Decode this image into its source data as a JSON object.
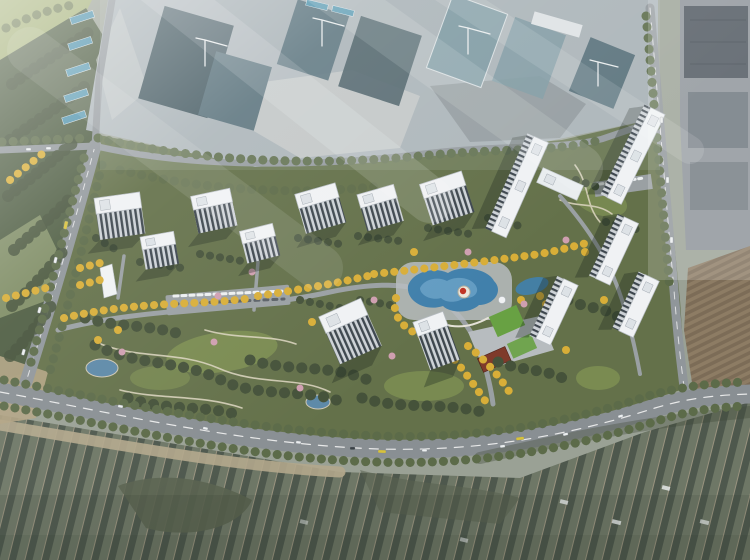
{
  "scene": {
    "type": "architectural-aerial-masterplan-render",
    "elements": [
      "construction-site",
      "tower-cranes",
      "residential-towers",
      "landscape-park",
      "swimming-lagoon",
      "kindergarten",
      "clubhouse",
      "arterial-road",
      "internal-roads",
      "parking-rows",
      "farmland-greenhouses",
      "forest-belt",
      "east-city-blocks",
      "brown-plowed-field",
      "temporary-site-housing"
    ],
    "counts": {
      "residential_towers": 14,
      "tower_cranes": 4
    }
  },
  "colors": {
    "base": "#9aa195",
    "dev_base": "#64714a",
    "lawn": "#7c8e52",
    "lawn_bright": "#68a143",
    "tree_dark": "#45523a",
    "tree_olive": "#5c6b49",
    "tree_yellow": "#d8ae38",
    "tree_pink": "#cf9fb0",
    "forest": "#4e5d42",
    "field": "#a3b075",
    "field2": "#8c9a6e",
    "road": "#90969a",
    "arterial": "#898f93",
    "internal_road": "#9aa0a3",
    "path": "#d8d2bc",
    "plaza": "#b7bcbf",
    "pool": "#4180ab",
    "pool_light": "#6ba3c8",
    "pond": "#5d89a8",
    "island": "#ece7dc",
    "red_feature": "#c03526",
    "red_roof": "#7f3a2b",
    "construction_base": "#a9b1b6",
    "construction_dark": "#41565e",
    "construction_mid": "#556e78",
    "construction_light": "#7b97a0",
    "rubble_light": "#c3c8c7",
    "rubble_dark": "#8a9296",
    "city_base": "#8b9298",
    "city_dark": "#4b545c",
    "city_mid": "#6b747c",
    "farm_base": "#6e7766",
    "farm_dark": "#4e584d",
    "farm_line": "#99937f",
    "mound": "#5a6350",
    "embankment": "#b3a78c",
    "dirt": "#b1a383",
    "brown_field": "#8d7c64",
    "brown_dark": "#7c6c57",
    "temp_blue": "#4f93ad",
    "facade_dark": "#3d464e",
    "facade_light": "#cdd2d7",
    "car_white": "#eceff0",
    "crane": "#e9eced",
    "paving": "#9aa0a2"
  }
}
